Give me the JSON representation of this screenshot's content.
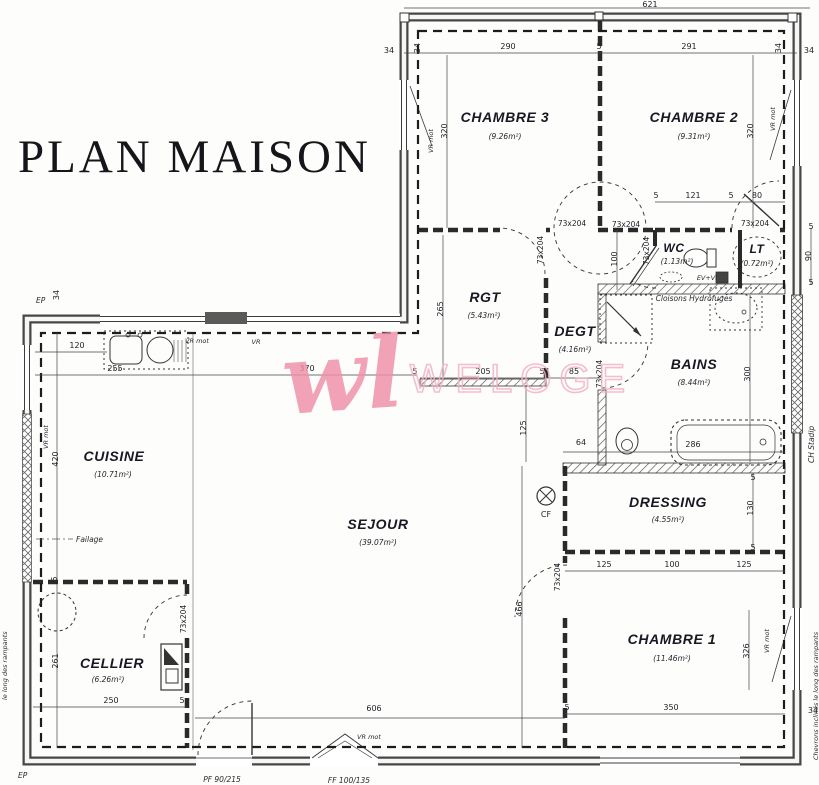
{
  "title": "PLAN MAISON",
  "watermark": {
    "script_text": "wl",
    "brand_text": "WELOGE",
    "color": "#ef8fa7"
  },
  "colors": {
    "ink": "#23232a",
    "wall": "#474747",
    "accent_pink": "#ef8fa7"
  },
  "rooms": [
    {
      "name": "CHAMBRE 3",
      "area": "(9.26m²)"
    },
    {
      "name": "CHAMBRE 2",
      "area": "(9.31m²)"
    },
    {
      "name": "WC",
      "area": "(1.13m²)"
    },
    {
      "name": "LT",
      "area": "(0.72m²)"
    },
    {
      "name": "RGT",
      "area": "(5.43m²)"
    },
    {
      "name": "DEGT",
      "area": "(4.16m²)"
    },
    {
      "name": "BAINS",
      "area": "(8.44m²)"
    },
    {
      "name": "CUISINE",
      "area": "(10.71m²)"
    },
    {
      "name": "SEJOUR",
      "area": "(39.07m²)"
    },
    {
      "name": "DRESSING",
      "area": "(4.55m²)"
    },
    {
      "name": "CHAMBRE 1",
      "area": "(11.46m²)"
    },
    {
      "name": "CELLIER",
      "area": "(6.26m²)"
    }
  ],
  "door_label": "73x204",
  "dims": [
    "621",
    "34",
    "290",
    "5",
    "291",
    "34",
    "34",
    "34",
    "320",
    "320",
    "5",
    "121",
    "5",
    "80",
    "100",
    "5",
    "90",
    "5",
    "265",
    "205",
    "5",
    "85",
    "300",
    "125",
    "64",
    "286",
    "5",
    "130",
    "5",
    "125",
    "100",
    "125",
    "466",
    "326",
    "350",
    "5",
    "34",
    "606",
    "250",
    "5",
    "261",
    "420",
    "5",
    "120",
    "255",
    "370",
    "5",
    "34"
  ],
  "annotations": {
    "ep": "EP",
    "faitage": "Failage",
    "cloisons": "Cloisons Hydrofuges",
    "evvi": "EV+VI",
    "cf": "CF",
    "vr_mot": "VR mot",
    "vr": "VR",
    "ch_stadip": "CH Stadip",
    "chevrons": "Chevrons inclinés le long des rampants",
    "rampants_left": "le long des rampants",
    "pf": "PF 90/215",
    "ff": "FF 100/135"
  }
}
